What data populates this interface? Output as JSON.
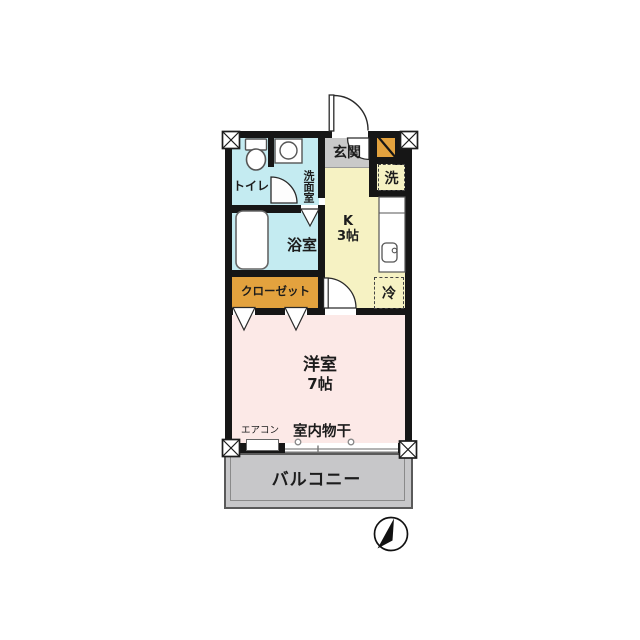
{
  "rooms": {
    "entrance": {
      "label": "玄関"
    },
    "toilet": {
      "label": "トイレ"
    },
    "washroom": {
      "label": "洗面室"
    },
    "bathroom": {
      "label": "浴室"
    },
    "kitchen": {
      "name": "K",
      "size": "3帖"
    },
    "closet": {
      "label": "クローゼット"
    },
    "western_room": {
      "name": "洋室",
      "size": "7帖"
    },
    "balcony": {
      "label": "バルコニー"
    }
  },
  "fixtures": {
    "washing_machine": {
      "label": "洗"
    },
    "refrigerator": {
      "label": "冷"
    },
    "air_conditioner": {
      "label": "エアコン"
    },
    "indoor_laundry": {
      "label": "室内物干"
    }
  },
  "colors": {
    "wall": "#161616",
    "water_rooms": "#c4ebf1",
    "kitchen": "#f6f2c3",
    "living_room": "#fce9e7",
    "closet": "#e3a23e",
    "entrance_floor": "#c9c9c9",
    "balcony": "#c7c7c9"
  }
}
